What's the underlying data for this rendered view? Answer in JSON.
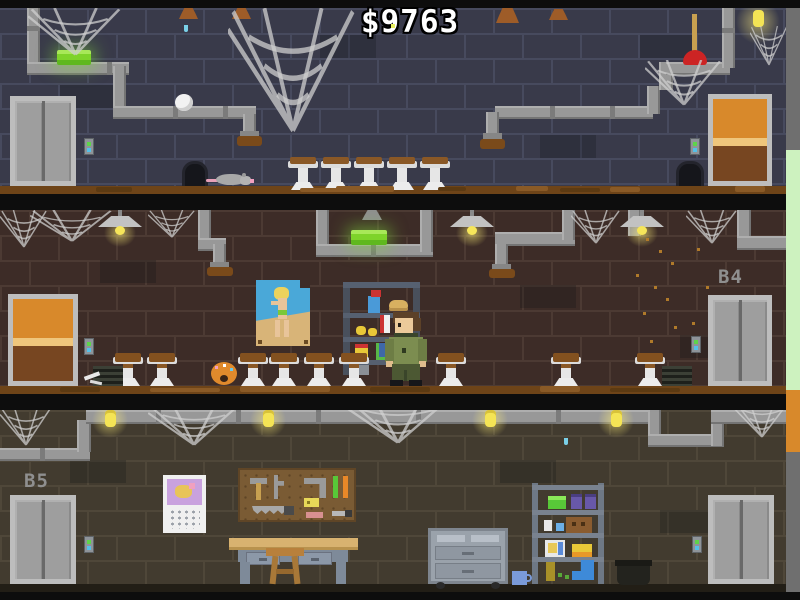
{
  "hud": {
    "money": "$9763"
  },
  "labels": {
    "floor_b4": "B4",
    "floor_b5": "B5"
  },
  "palette": {
    "wall_top": "#393a4a",
    "wall_middle": "#3d2c27",
    "wall_bottom": "#423b2f",
    "pipe_gray": "#989898",
    "door_orange": "#d8892b",
    "tube_green": "#7ed32a",
    "bulb_yellow": "#f4e455",
    "dirt_brown": "#6e4418",
    "shaft_green": "#cdf2bf",
    "call_button_green": "#5ed44a",
    "call_button_blue": "#54c0e8"
  },
  "scene": {
    "floors": [
      {
        "name": "basement-top",
        "objects": [
          "elevator",
          "call-button-panel",
          "green-tube-light",
          "toilet-paper-wad",
          "rat",
          "rat-hole",
          "toilets",
          "plunger",
          "wooden-door",
          "light-bulb",
          "cobwebs",
          "pipes"
        ]
      },
      {
        "name": "basement-b4",
        "objects": [
          "wooden-door",
          "ceiling-lamps",
          "pinup-poster",
          "supply-shelf",
          "player-character",
          "toilets",
          "donut",
          "vent-grates",
          "elevator",
          "falling-dust",
          "cobwebs",
          "pipes"
        ]
      },
      {
        "name": "basement-b5",
        "objects": [
          "elevator-left",
          "elevator-right",
          "calendar",
          "pegboard-tools",
          "workbench",
          "stool",
          "tool-cabinet",
          "mug",
          "storage-shelf",
          "trash-pot",
          "light-bulbs",
          "cobwebs",
          "pipes"
        ]
      }
    ]
  }
}
